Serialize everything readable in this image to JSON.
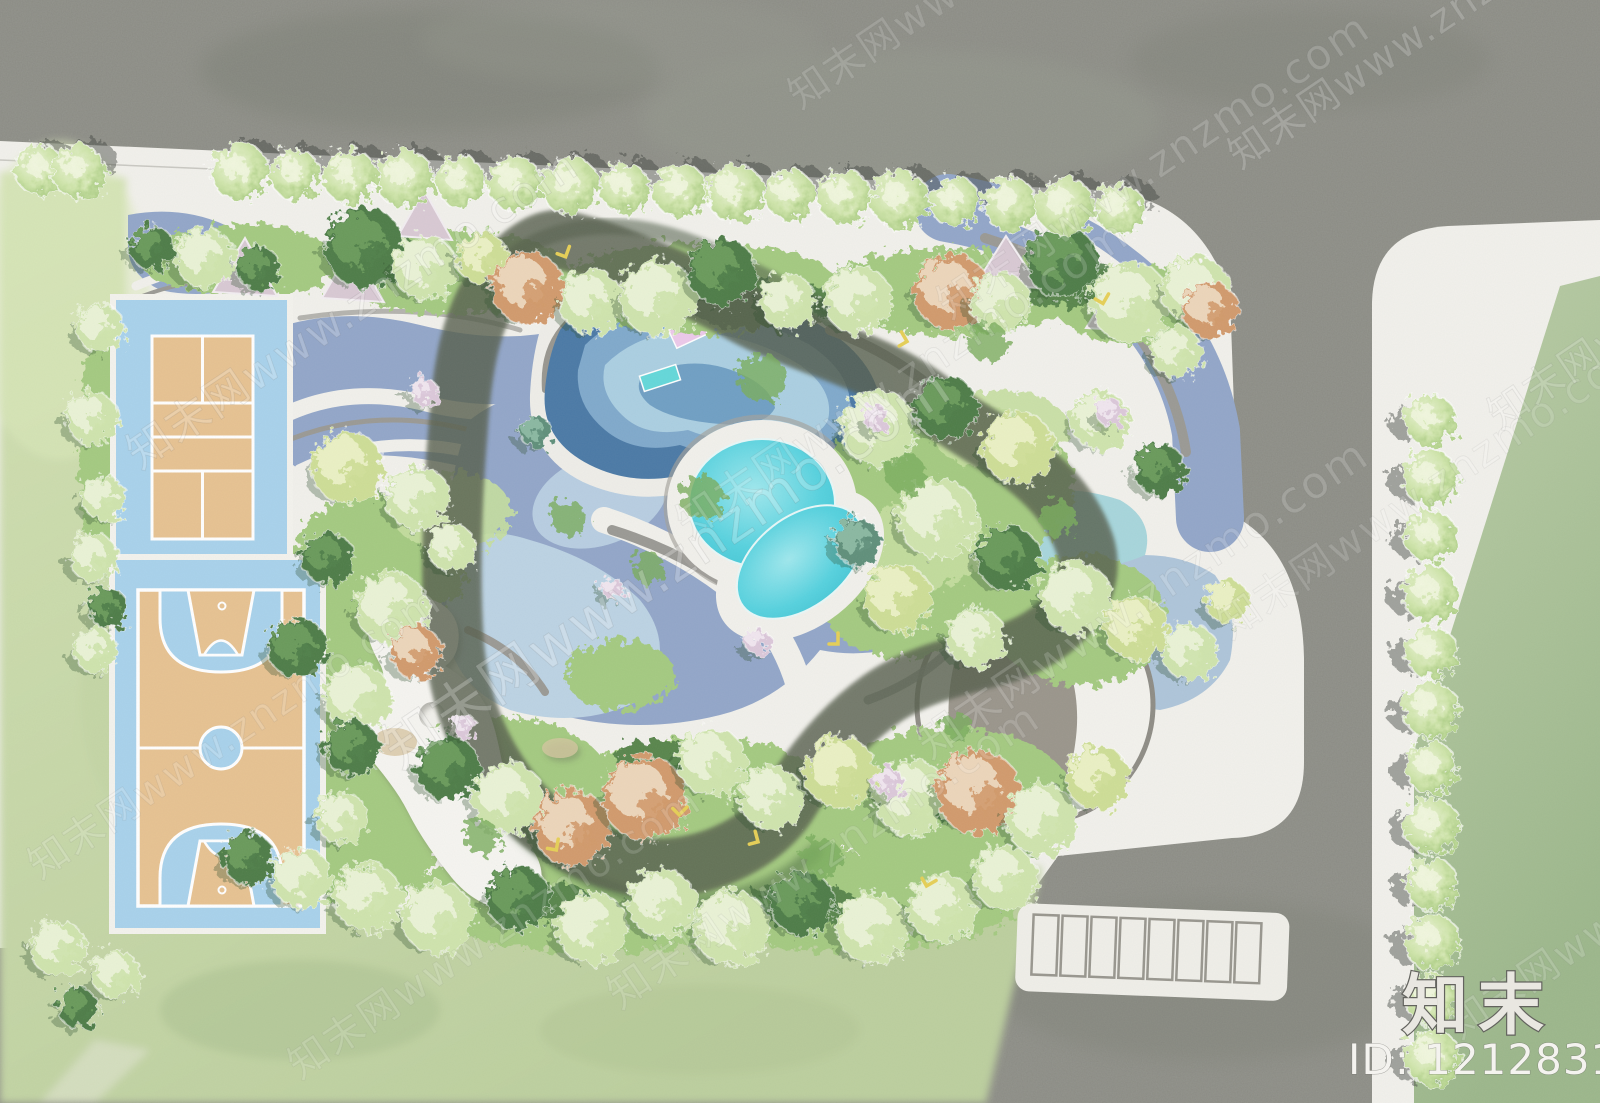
{
  "watermark": {
    "tile_text": "知末网www.znzmo.com",
    "logo_text": "知末",
    "id_text": "ID: 1212831201"
  },
  "plan": {
    "drawing_kind": "park landscape master plan, top view",
    "site_features": [
      {
        "name": "urban-road",
        "color": "#8a8a83"
      },
      {
        "name": "sidewalk-paving",
        "color": "#f2f1ec"
      },
      {
        "name": "lawn",
        "color": "#c2d3a4"
      },
      {
        "name": "street-tree-row-top",
        "count": 20
      },
      {
        "name": "street-tree-row-right",
        "count": 12
      },
      {
        "name": "tennis-court",
        "surface": "#e7c291",
        "apron": "#a8d2ec"
      },
      {
        "name": "basketball-court",
        "surface": "#e7c291",
        "apron": "#a8d2ec"
      },
      {
        "name": "jogging-loop",
        "color": "#f4ef90"
      },
      {
        "name": "kids-pool",
        "color": "#4a79a6",
        "floats": [
          "#edc9ea",
          "#63d8da"
        ]
      },
      {
        "name": "round-pool",
        "color": "#4fd0de"
      },
      {
        "name": "oval-pool",
        "color": "#4fd0de"
      },
      {
        "name": "water-paving",
        "color": "#92a6c9"
      },
      {
        "name": "amphitheater-plaza",
        "color": "#9a958b"
      },
      {
        "name": "parking-stalls",
        "count": 8
      }
    ]
  },
  "colors": {
    "road": "#8a8a83",
    "road-light": "#9ba093",
    "sidewalk": "#f2f1ec",
    "lawn-1": "#cfdfb0",
    "lawn-2": "#b7cb9b",
    "lawn-right-1": "#b7c9a2",
    "lawn-right-2": "#9db88c",
    "green-base": "#a4ca80",
    "green-light": "#c6dfa0",
    "green-dark": "#4c7a44",
    "water-periwinkle": "#92a6c9",
    "water-light": "#aec5da",
    "water-pale": "#bcd3e4",
    "water-cyanish": "#a7d6dc",
    "pond-dark": "#4a79a6",
    "pond-mid": "#7fa9cc",
    "pond-light": "#abcfe2",
    "pond-core": "#6f9fc4",
    "pool-cyan": "#4fd0de",
    "pool-hi": "#a5e9ef",
    "loop-yellow": "#f4ef90",
    "loop-shadow": "#565e4d",
    "path-gray": "#9a9994",
    "plaza-gray": "#9a958b",
    "sand-tan": "#d8c6a2",
    "court-sand": "#e7c291",
    "court-blue": "#a8d2ec",
    "bed-pink": "#d9c9d4",
    "float-pink": "#edc9ea",
    "float-cyan": "#63d8da",
    "tree-street": "#cde3a8",
    "tree-light": "#cfe4ad",
    "tree-hi": "#eef6dd",
    "tree-yellow": "#cede96",
    "tree-dark": "#4e7c46",
    "tree-orange": "#d29a6c",
    "tree-teal": "#5e8f7a",
    "tree-pink": "#dcc8da",
    "watermark": "rgba(255,255,255,0.42)",
    "logo-fill": "#e9e7e1",
    "logo-stroke": "#63635e",
    "id-fill": "#f4f3ef"
  }
}
